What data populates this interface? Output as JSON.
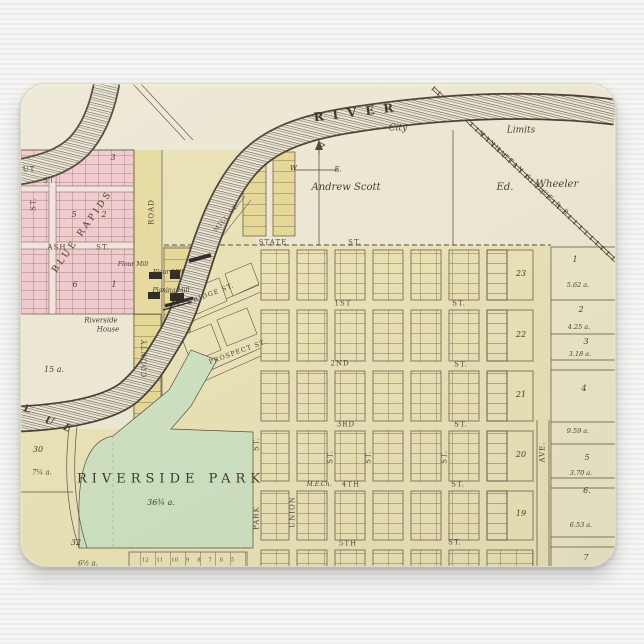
{
  "scene": {
    "product": "mousepad photo on light surface",
    "background_color": "#f2f1ee",
    "paper_color": "#ece7d2",
    "ink_color": "#473e31",
    "region_colors": {
      "pink": "#efc9cb",
      "block_yellow": "#e8e1b4",
      "lot_yellow": "#e5d795",
      "park_green": "#cde0c0",
      "cream": "#ece7d2"
    }
  },
  "map": {
    "labels": {
      "river": "RIVER",
      "city": "City",
      "limits": "Limits",
      "railroad": "MANHATTAN & BLUE R.R.",
      "andrew_scott": "Andrew Scott",
      "ed": "Ed.",
      "wheeler": "Wheeler",
      "w": "W.",
      "e": "E.",
      "blue_rapids": "BLUE RAPIDS",
      "ash": "ASH",
      "st": "ST.",
      "ut": "UT",
      "road": "ROAD",
      "county": "COUNTY",
      "flour_mill": "Flour Mill",
      "planing_mill": "Planing Mill",
      "riverside": "Riverside",
      "house": "House",
      "a15": "15 a.",
      "mill_st": "MILL ST.",
      "bridge_st": "BRIDGE ST.",
      "prospect_st": "PROSPECT ST.",
      "state": "STATE",
      "first": "1ST",
      "second": "2ND",
      "third": "3RD",
      "fourth": "4TH",
      "fifth": "5TH",
      "me_church": "M.E.Ch.",
      "union": "UNION",
      "park_st": "PARK",
      "ave": "AVE.",
      "riverside_park": "RIVERSIDE PARK",
      "park_acres": "36¾ a.",
      "n30": "30",
      "a7q": "7¼ a.",
      "n32": "32",
      "a6h": "6½ a.",
      "blue_l": "L",
      "blue_u": "U",
      "blue_e": "E",
      "lot_row": "12 11 10 9 8 7 6 5"
    },
    "pink_blocks": [
      "3",
      "2",
      "5",
      "6",
      "1"
    ],
    "blocks_right": [
      "23",
      "22",
      "21",
      "20",
      "19"
    ],
    "parcel_numbers": [
      "1",
      "2",
      "3",
      "4",
      "5",
      "6.",
      "7"
    ],
    "parcel_acres": [
      "5.62 a.",
      "4.25 a.",
      "3.18 a.",
      "9.59 a.",
      "3.70 a.",
      "6.53 a."
    ]
  }
}
